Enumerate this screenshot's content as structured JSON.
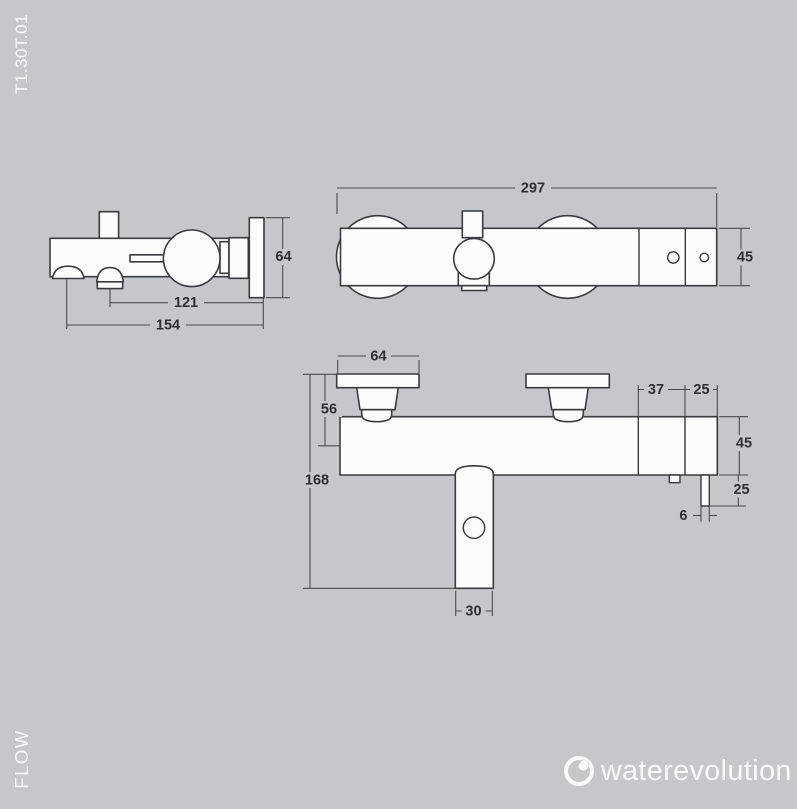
{
  "page": {
    "background": "#c5c7cb",
    "line_color": "#3a3b3e",
    "model_code": "T1.30T.01",
    "series_label": "FLOW",
    "brand": "waterevolution"
  },
  "side_view": {
    "dims": {
      "plate_height": "64",
      "spout_to_plate": "121",
      "total_depth": "154"
    }
  },
  "front_view": {
    "dims": {
      "total_width": "297",
      "body_height": "45"
    }
  },
  "top_view": {
    "dims": {
      "flange_width": "64",
      "wall_to_axis": "56",
      "spout_reach": "168",
      "seg_a": "37",
      "seg_b": "25",
      "body_depth": "45",
      "rod_length": "25",
      "rod_width": "6",
      "spout_width": "30"
    }
  }
}
